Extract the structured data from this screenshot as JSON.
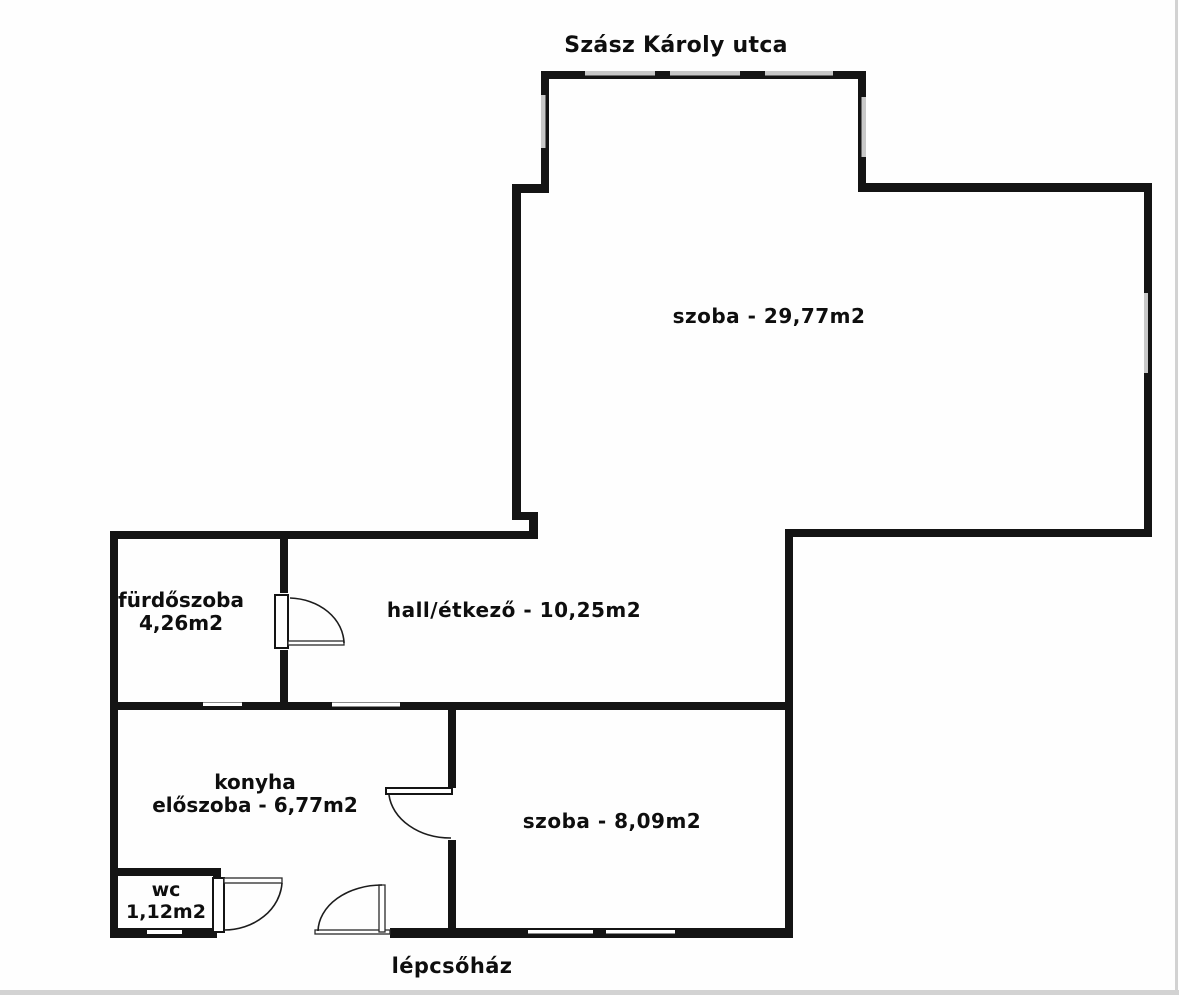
{
  "street_label": "Szász Károly utca",
  "staircase_label": "lépcsőház",
  "rooms": {
    "large_room": {
      "label": "szoba - 29,77m2"
    },
    "hall": {
      "label": "hall/étkező - 10,25m2"
    },
    "small_room": {
      "label": "szoba - 8,09m2"
    },
    "bathroom": {
      "line1": "fürdőszoba",
      "line2": "4,26m2"
    },
    "kitchen": {
      "line1": "konyha",
      "line2": "előszoba - 6,77m2"
    },
    "wc": {
      "line1": "wc",
      "line2": "1,12m2"
    }
  },
  "colors": {
    "wall": "#141414",
    "window": "#c8c8c8",
    "background": "#fefefe",
    "text": "#0e0e0e",
    "edge": "#d2d2d2"
  }
}
